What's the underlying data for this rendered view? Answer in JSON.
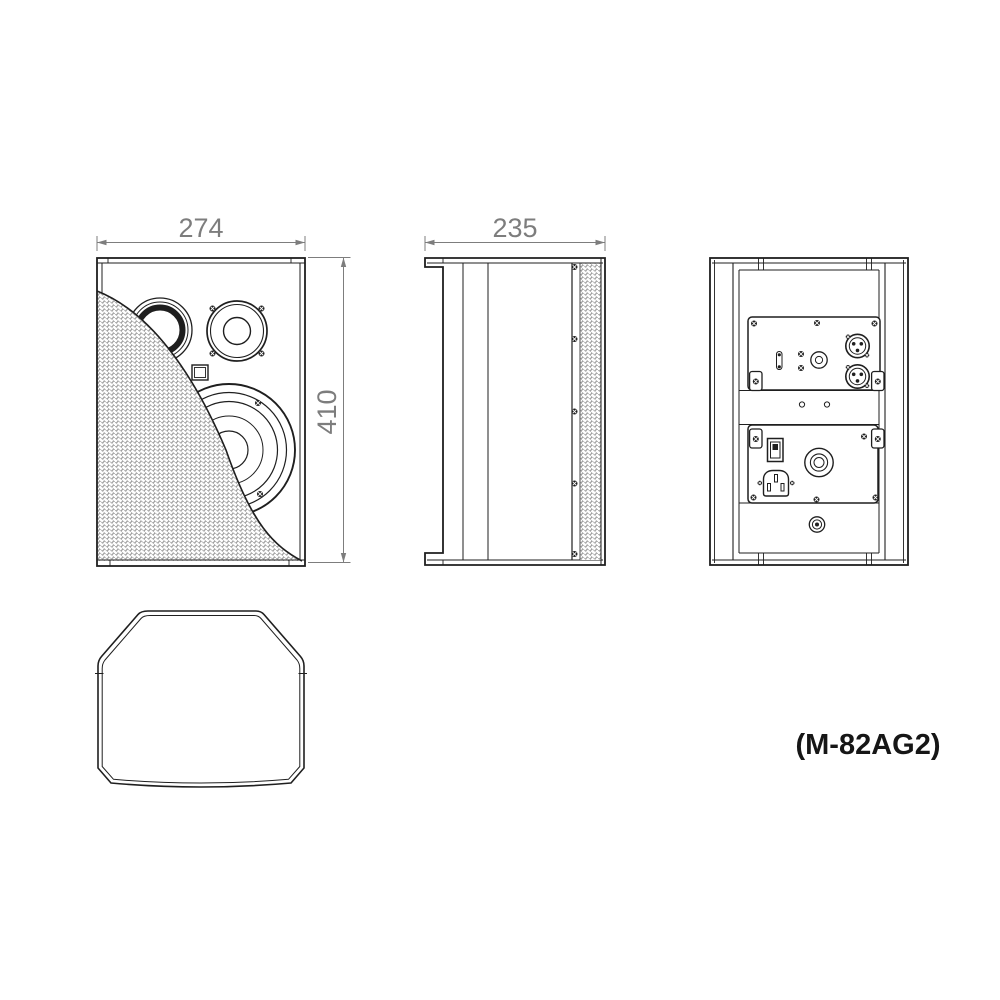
{
  "model_label": "(M-82AG2)",
  "dimensions": {
    "front_width_mm": "274",
    "front_height_mm": "410",
    "side_depth_mm": "235"
  },
  "colors": {
    "background": "#ffffff",
    "line": "#1f1f1f",
    "dimension_gray": "#7d7d7d",
    "grille_mesh_gray": "#909090"
  },
  "views": {
    "front": "front-view",
    "side": "side-view",
    "rear": "rear-view",
    "plan": "plan-view"
  },
  "icons": [
    "tweeter-horn-icon",
    "mid-driver-icon",
    "bass-port-icon",
    "woofer-icon",
    "grille-mesh-icon",
    "screw-icon",
    "fuse-holder-icon",
    "gain-knob-icon",
    "xlr-connector-icon",
    "mounting-bracket-icon",
    "power-switch-icon",
    "iec-power-inlet-icon",
    "pole-mount-cup-icon",
    "threaded-insert-icon"
  ]
}
